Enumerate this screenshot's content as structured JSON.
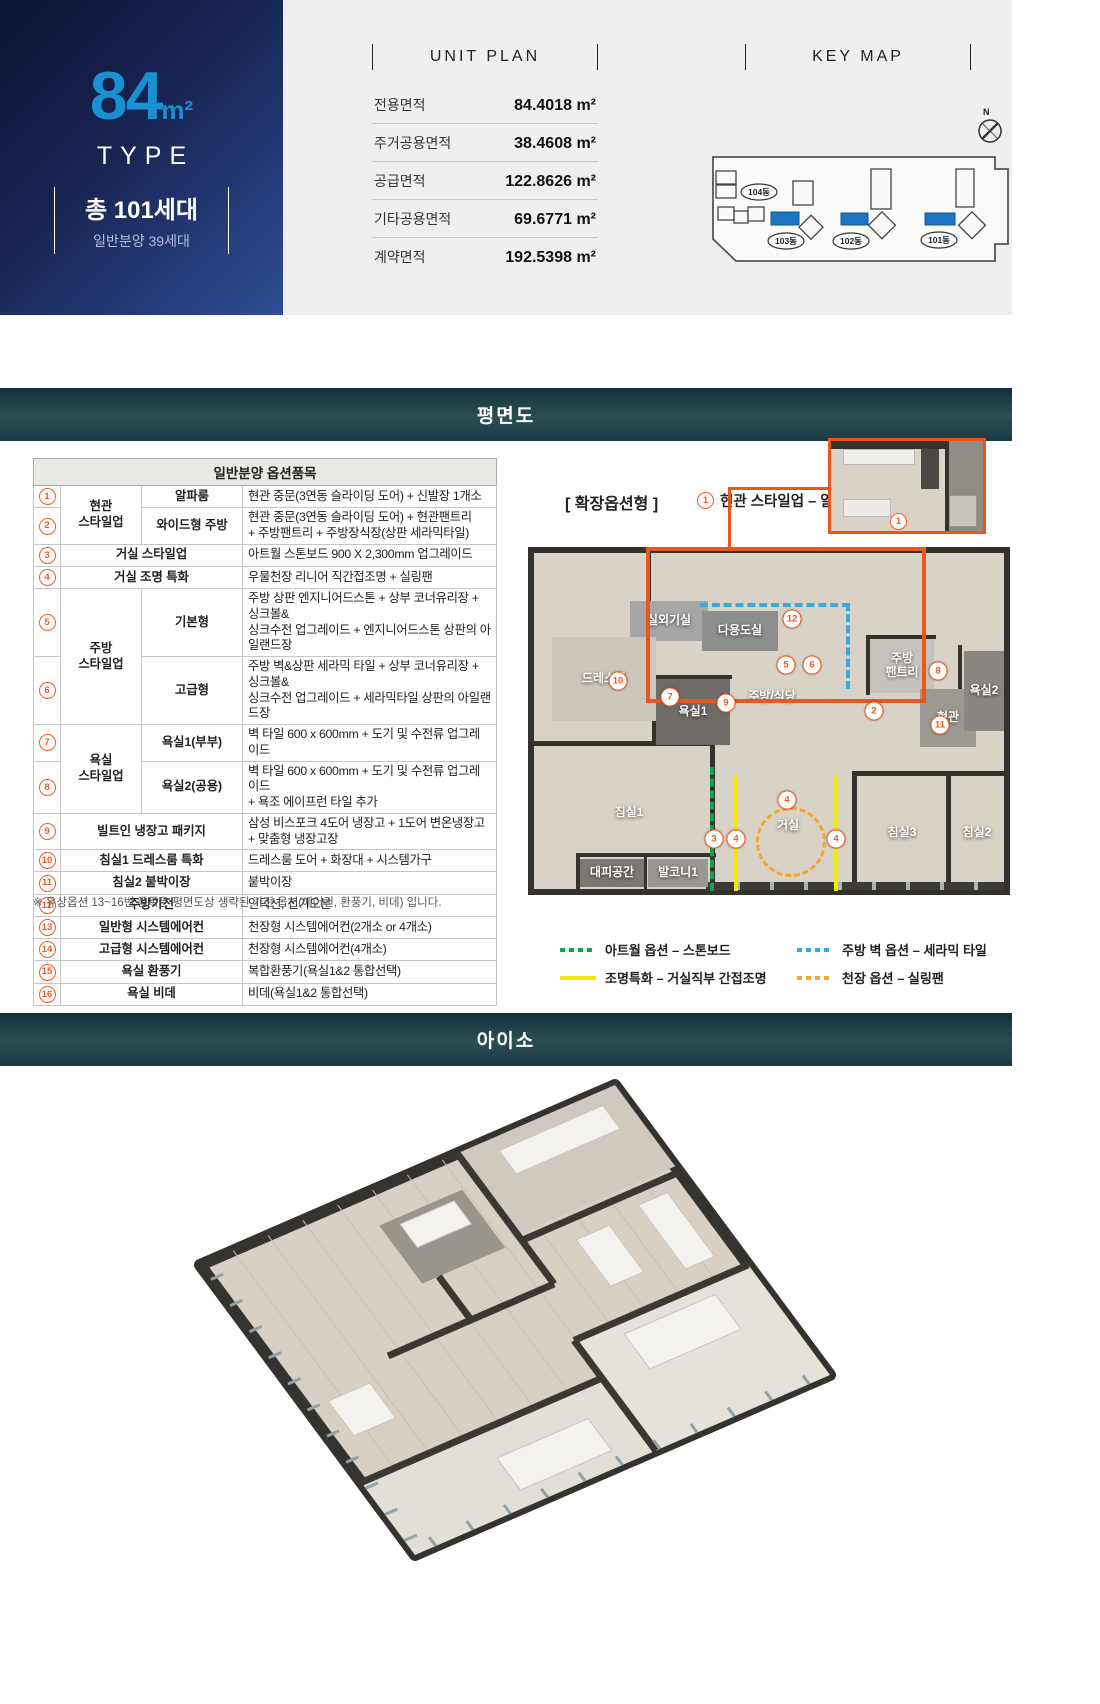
{
  "type_box": {
    "area_number": "84",
    "area_unit": "m²",
    "type_label": "TYPE",
    "total_households": "총 101세대",
    "general_sale": "일반분양 39세대"
  },
  "unit_plan": {
    "title": "UNIT PLAN",
    "rows": [
      {
        "label": "전용면적",
        "value": "84.4018 m²"
      },
      {
        "label": "주거공용면적",
        "value": "38.4608 m²"
      },
      {
        "label": "공급면적",
        "value": "122.8626 m²"
      },
      {
        "label": "기타공용면적",
        "value": "69.6771 m²"
      },
      {
        "label": "계약면적",
        "value": "192.5398 m²"
      }
    ]
  },
  "key_map": {
    "title": "KEY MAP",
    "compass": "N",
    "highlight_color": "#1b76c6",
    "buildings": [
      {
        "label": "104동"
      },
      {
        "label": "103동"
      },
      {
        "label": "102동"
      },
      {
        "label": "101동"
      }
    ]
  },
  "sections": {
    "floorplan_title": "평면도",
    "iso_title": "아이소"
  },
  "options_table": {
    "title": "일반분양 옵션품목",
    "rows": [
      {
        "num": "1",
        "cells": [
          {
            "t": "현관\n스타일업",
            "rs": 2
          },
          {
            "t": "알파룸"
          }
        ],
        "desc": "현관 중문(3연동 슬라이딩 도어) + 신발장 1개소"
      },
      {
        "num": "2",
        "cells": [
          {
            "t": "와이드형 주방"
          }
        ],
        "desc": "현관 중문(3연동 슬라이딩 도어) + 현관팬트리\n+ 주방팬트리 + 주방장식장(상판 세라믹타일)"
      },
      {
        "num": "3",
        "cells": [
          {
            "t": "거실 스타일업",
            "cs": 2
          }
        ],
        "desc": "아트월 스톤보드 900 X 2,300mm 업그레이드"
      },
      {
        "num": "4",
        "cells": [
          {
            "t": "거실 조명 특화",
            "cs": 2
          }
        ],
        "desc": "우물천장 리니어 직간접조명 + 실링팬"
      },
      {
        "num": "5",
        "cells": [
          {
            "t": "주방\n스타일업",
            "rs": 2
          },
          {
            "t": "기본형"
          }
        ],
        "desc": "주방 상판 엔지니어드스톤 + 상부 코너유리장 + 싱크볼&\n싱크수전 업그레이드 + 엔지니어드스톤 상판의 아일랜드장"
      },
      {
        "num": "6",
        "cells": [
          {
            "t": "고급형"
          }
        ],
        "desc": "주방 벽&상판 세라믹 타일 + 상부 코너유리장 + 싱크볼&\n싱크수전 업그레이드 + 세라믹타일 상판의 아일랜드장"
      },
      {
        "num": "7",
        "cells": [
          {
            "t": "욕실\n스타일업",
            "rs": 2
          },
          {
            "t": "욕실1(부부)"
          }
        ],
        "desc": "벽 타일 600 x 600mm + 도기 및 수전류 업그레이드"
      },
      {
        "num": "8",
        "cells": [
          {
            "t": "욕실2(공용)"
          }
        ],
        "desc": "벽 타일 600 x 600mm + 도기 및 수전류 업그레이드\n+ 욕조 에이프런 타일 추가"
      },
      {
        "num": "9",
        "cells": [
          {
            "t": "빌트인 냉장고 패키지",
            "cs": 2
          }
        ],
        "desc": "삼성 비스포크 4도어 냉장고 + 1도어 변온냉장고\n+ 맞춤형 냉장고장"
      },
      {
        "num": "10",
        "cells": [
          {
            "t": "침실1 드레스룸 특화",
            "cs": 2
          }
        ],
        "desc": "드레스룸 도어 + 화장대 + 시스템가구"
      },
      {
        "num": "11",
        "cells": [
          {
            "t": "침실2 붙박이장",
            "cs": 2
          }
        ],
        "desc": "붙박이장"
      },
      {
        "num": "12",
        "cells": [
          {
            "t": "주방가전",
            "cs": 2
          }
        ],
        "desc": "인덕션, 전기오븐"
      },
      {
        "num": "13",
        "cells": [
          {
            "t": "일반형 시스템에어컨",
            "cs": 2
          }
        ],
        "desc": "천장형 시스템에어컨(2개소 or 4개소)"
      },
      {
        "num": "14",
        "cells": [
          {
            "t": "고급형 시스템에어컨",
            "cs": 2
          }
        ],
        "desc": "천장형 시스템에어컨(4개소)"
      },
      {
        "num": "15",
        "cells": [
          {
            "t": "욕실 환풍기",
            "cs": 2
          }
        ],
        "desc": "복합환풍기(욕실1&2 통합선택)"
      },
      {
        "num": "16",
        "cells": [
          {
            "t": "욕실 비데",
            "cs": 2
          }
        ],
        "desc": "비데(욕실1&2 통합선택)"
      }
    ],
    "footnote": "※ 유상옵션 13~16번 품목은 평면도상 생략된 가전 옵션(에어컨, 환풍기, 비데) 입니다."
  },
  "expansion": {
    "bracket_label": "[ 확장옵션형 ]",
    "option1_num": "1",
    "option1_label": "현관 스타일업 – 알파룸 선택형",
    "inset_num": "1"
  },
  "floorplan": {
    "rooms": [
      {
        "name": "실외기실",
        "x": 96,
        "y": 48,
        "w": 78,
        "h": 40,
        "bg": "#a6a6a6"
      },
      {
        "name": "다용도실",
        "x": 168,
        "y": 58,
        "w": 76,
        "h": 40,
        "bg": "#8e8e8e"
      },
      {
        "name": "드레스룸",
        "x": 18,
        "y": 84,
        "w": 104,
        "h": 84,
        "bg": "#cdc6bb"
      },
      {
        "name": "욕실1",
        "x": 122,
        "y": 126,
        "w": 74,
        "h": 66,
        "bg": "#6f6b66"
      },
      {
        "name": "주방/식당",
        "x": 178,
        "y": 118,
        "w": 120,
        "h": 52,
        "bg": ""
      },
      {
        "name": "주방\n팬트리",
        "x": 336,
        "y": 86,
        "w": 64,
        "h": 54,
        "bg": "#c6c2bc"
      },
      {
        "name": "현관",
        "x": 386,
        "y": 136,
        "w": 56,
        "h": 58,
        "bg": "#9c9892"
      },
      {
        "name": "욕실2",
        "x": 430,
        "y": 98,
        "w": 40,
        "h": 80,
        "bg": "#8a8681"
      },
      {
        "name": "침실1",
        "x": 20,
        "y": 200,
        "w": 150,
        "h": 120,
        "bg": ""
      },
      {
        "name": "거실",
        "x": 206,
        "y": 248,
        "w": 96,
        "h": 50,
        "bg": ""
      },
      {
        "name": "침실3",
        "x": 326,
        "y": 232,
        "w": 84,
        "h": 96,
        "bg": ""
      },
      {
        "name": "침실2",
        "x": 416,
        "y": 232,
        "w": 54,
        "h": 96,
        "bg": ""
      },
      {
        "name": "대피공간",
        "x": 46,
        "y": 306,
        "w": 64,
        "h": 28,
        "bg": "#7b7773"
      },
      {
        "name": "발코니1",
        "x": 114,
        "y": 306,
        "w": 60,
        "h": 28,
        "bg": "#9a9690"
      }
    ],
    "markers": [
      {
        "n": "12",
        "x": 258,
        "y": 66
      },
      {
        "n": "5",
        "x": 252,
        "y": 112
      },
      {
        "n": "6",
        "x": 278,
        "y": 112
      },
      {
        "n": "9",
        "x": 192,
        "y": 150
      },
      {
        "n": "2",
        "x": 340,
        "y": 158
      },
      {
        "n": "7",
        "x": 136,
        "y": 144
      },
      {
        "n": "10",
        "x": 84,
        "y": 128
      },
      {
        "n": "8",
        "x": 404,
        "y": 118
      },
      {
        "n": "11",
        "x": 406,
        "y": 172
      },
      {
        "n": "4",
        "x": 253,
        "y": 247
      },
      {
        "n": "3",
        "x": 180,
        "y": 286
      },
      {
        "n": "4",
        "x": 202,
        "y": 286
      },
      {
        "n": "4",
        "x": 302,
        "y": 286
      }
    ]
  },
  "legend": {
    "items": [
      {
        "label": "아트월 옵션 – 스톤보드",
        "color": "#12a14e",
        "style": "dotted"
      },
      {
        "label": "주방 벽 옵션 – 세라믹 타일",
        "color": "#35aae9",
        "style": "dotted"
      },
      {
        "label": "조명특화 – 거실직부 간접조명",
        "color": "#f6e70a",
        "style": "solid"
      },
      {
        "label": "천장 옵션 – 실링팬",
        "color": "#f5a62b",
        "style": "dotted"
      }
    ]
  }
}
